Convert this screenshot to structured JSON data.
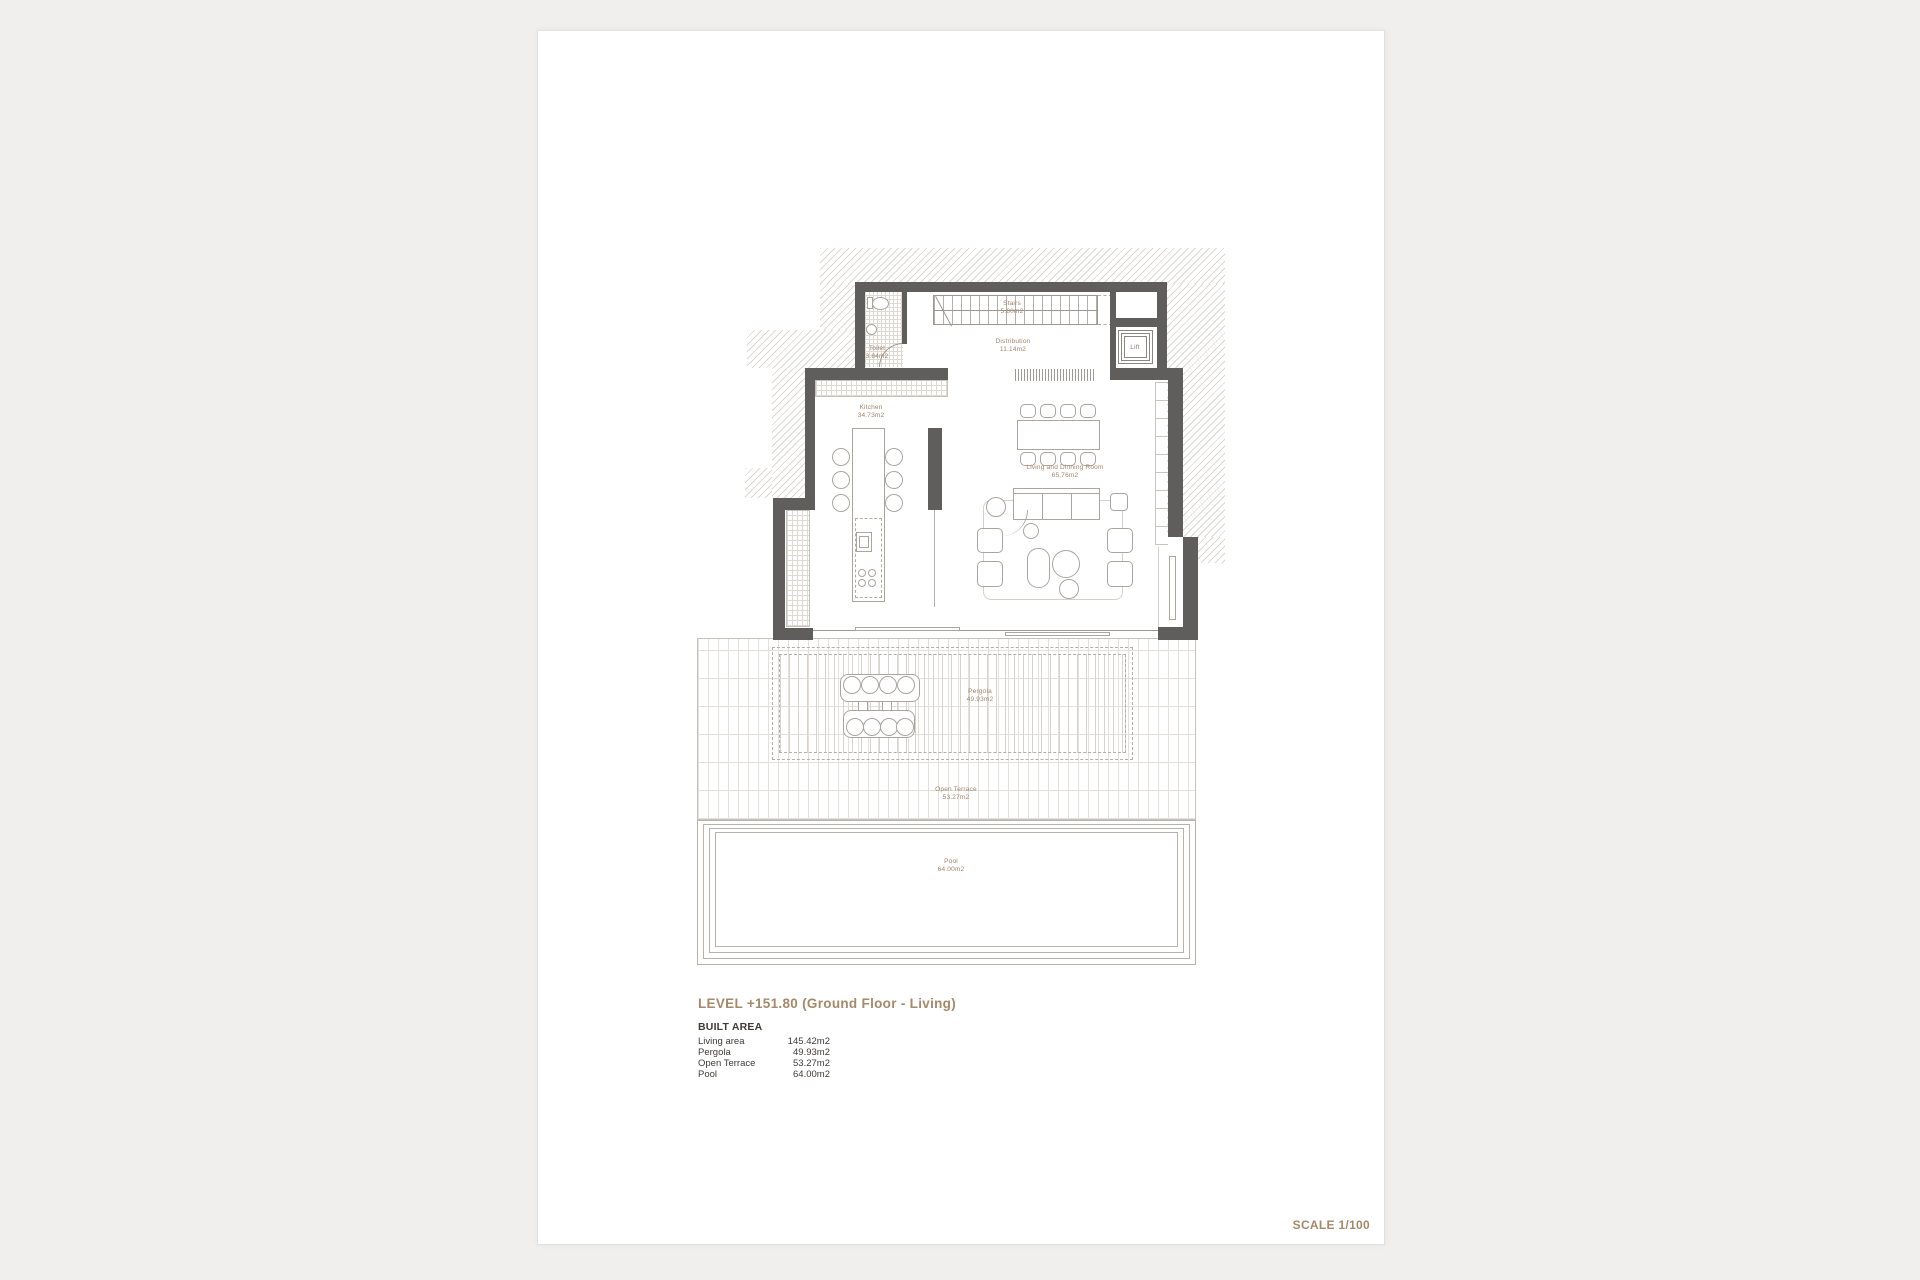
{
  "palette": {
    "canvas_bg": "#f0efed",
    "sheet_bg": "#ffffff",
    "wall_color": "#5f5e5c",
    "accent_text": "#a5896a",
    "dark_text": "#3e3c39"
  },
  "title_block": {
    "level_title": "LEVEL +151.80 (Ground Floor - Living)",
    "built_area_heading": "BUILT AREA",
    "areas": [
      {
        "label": "Living area",
        "value": "145.42m2"
      },
      {
        "label": "Pergola",
        "value": "49.93m2"
      },
      {
        "label": "Open Terrace",
        "value": "53.27m2"
      },
      {
        "label": "Pool",
        "value": "64.00m2"
      }
    ],
    "scale_label": "SCALE 1/100"
  },
  "rooms": [
    {
      "name": "Stairs",
      "area": "5.80m2"
    },
    {
      "name": "Distribution",
      "area": "11.14m2"
    },
    {
      "name": "Toilet",
      "area": "3.84m2"
    },
    {
      "name": "Lift",
      "area": ""
    },
    {
      "name": "Kitchen",
      "area": "34.73m2"
    },
    {
      "name": "Living and Dinning Room",
      "area": "65.76m2"
    },
    {
      "name": "Pergola",
      "area": "49.93m2"
    },
    {
      "name": "Open Terrace",
      "area": "53.27m2"
    },
    {
      "name": "Pool",
      "area": "64.00m2"
    }
  ]
}
